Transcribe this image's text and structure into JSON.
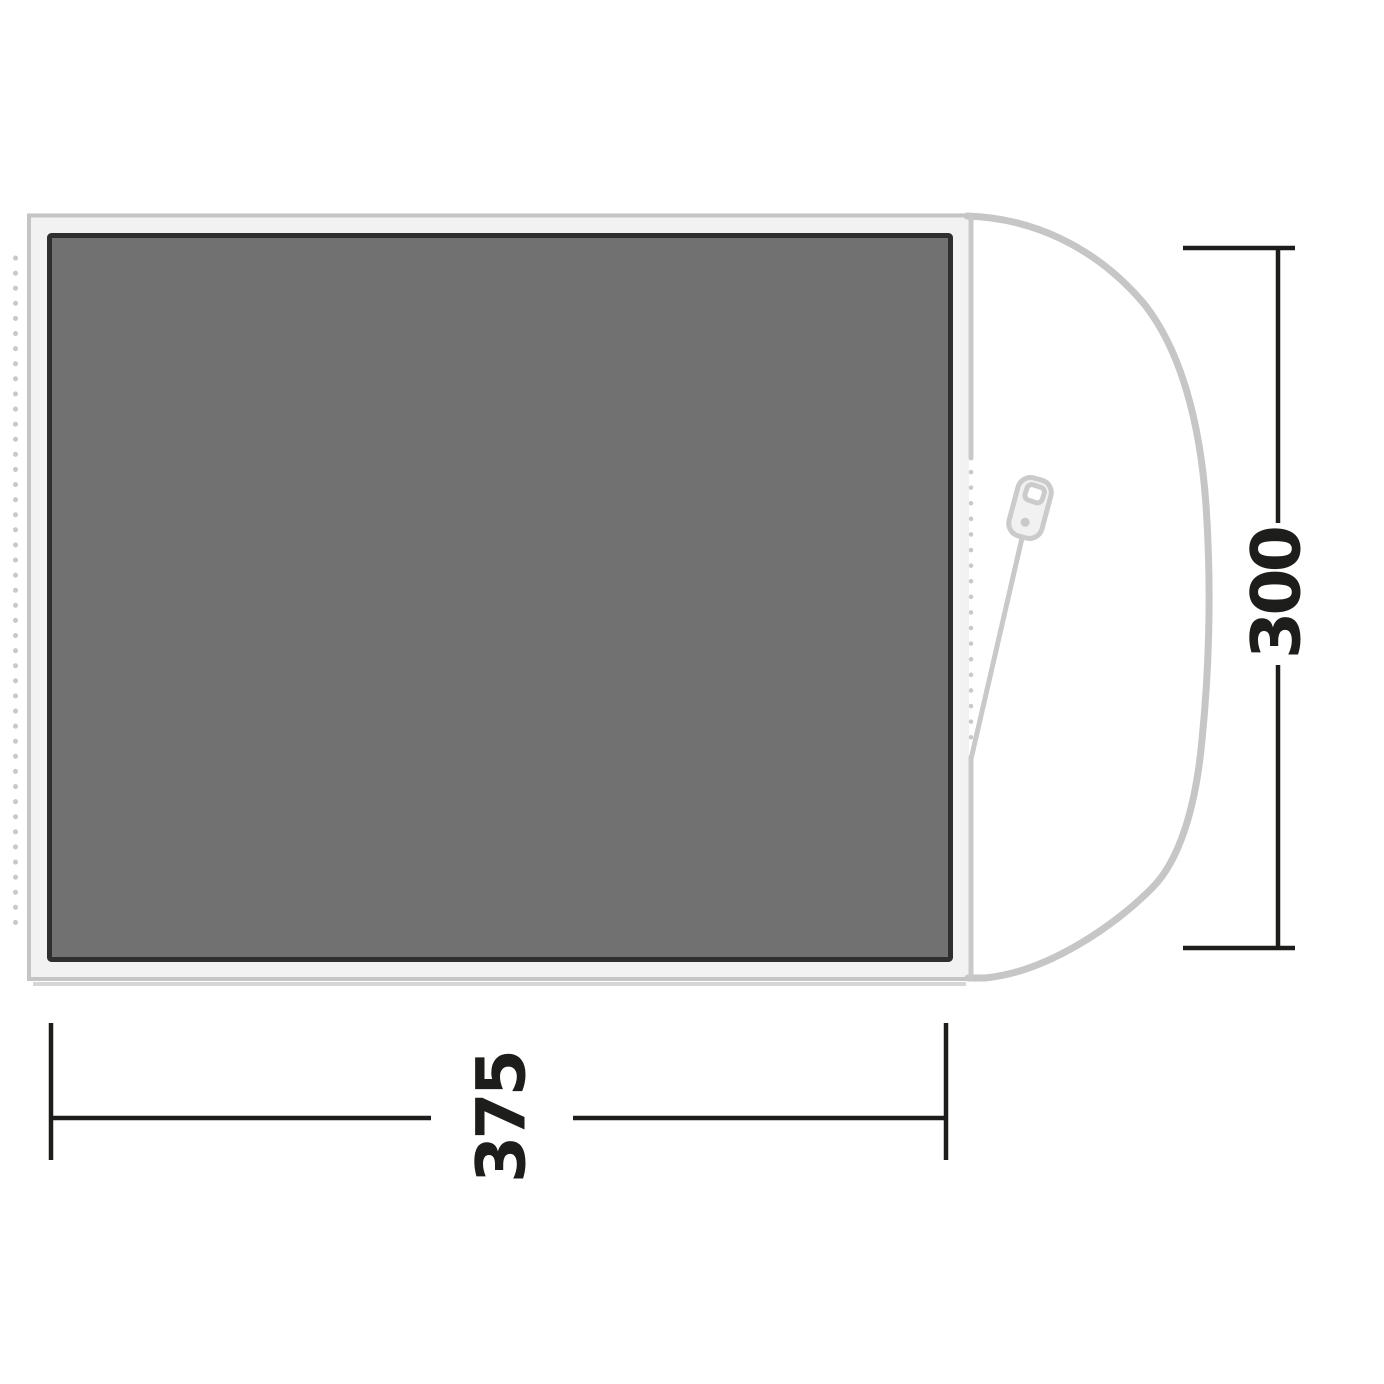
{
  "diagram": {
    "kind": "tent-groundsheet-top-view",
    "width_dimension": {
      "value": "375"
    },
    "depth_dimension": {
      "value": "300"
    },
    "colors": {
      "carpet_fill": "#717171",
      "carpet_outline": "#2f2f2f",
      "groundsheet_fill": "#f2f2f2",
      "groundsheet_outline": "#c5c5c5",
      "tent_outline": "#c6c6c6",
      "zipper_gray": "#cbcbcb",
      "dimension_black": "#1d1d1b",
      "background": "#ffffff"
    },
    "icons": {
      "zipper_pull": "zipper-pull-icon"
    }
  }
}
